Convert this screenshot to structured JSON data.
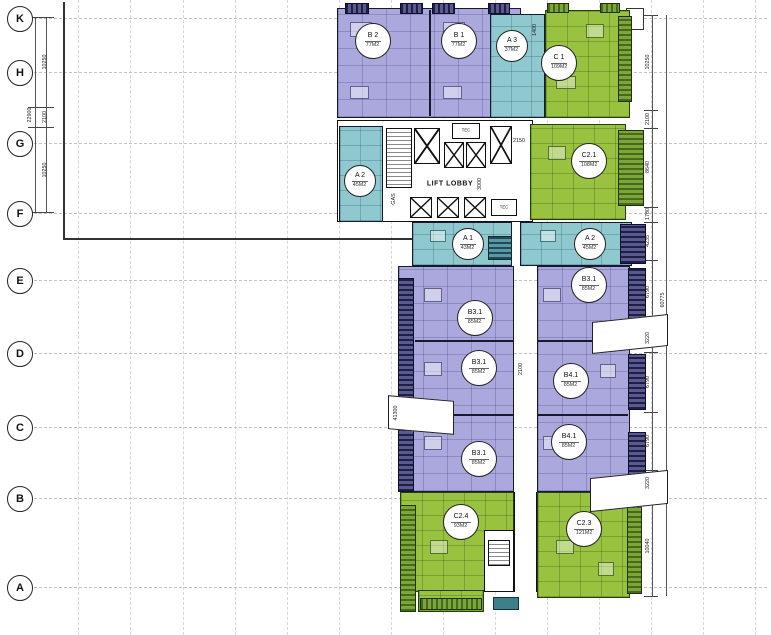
{
  "grid_rows": [
    {
      "label": "K"
    },
    {
      "label": "H"
    },
    {
      "label": "G"
    },
    {
      "label": "F"
    },
    {
      "label": "E"
    },
    {
      "label": "D"
    },
    {
      "label": "C"
    },
    {
      "label": "B"
    },
    {
      "label": "A"
    }
  ],
  "dims": {
    "left_overall": "22900",
    "left": [
      "10250",
      "2100",
      "10250"
    ],
    "right": [
      "10250",
      "2100",
      "8640",
      "1780",
      "4235",
      "6790",
      "3220",
      "6790",
      "6790",
      "3220",
      "10040"
    ],
    "right_overall": "60775",
    "inner": {
      "d1400": "1400",
      "d2150": "2150",
      "d3000": "3000",
      "d2100": "2100",
      "d41300": "41300"
    }
  },
  "labels": {
    "lift_lobby": "LIFT LOBBY",
    "tec": "TEC",
    "gas": "GAS"
  },
  "units": [
    {
      "code": "B 2",
      "area": "77M2"
    },
    {
      "code": "B 1",
      "area": "77M2"
    },
    {
      "code": "A 3",
      "area": "37M2"
    },
    {
      "code": "C 1",
      "area": "109M2"
    },
    {
      "code": "A 2",
      "area": "45M2"
    },
    {
      "code": "C2.1",
      "area": "108M2"
    },
    {
      "code": "A 1",
      "area": "43M2"
    },
    {
      "code": "A 2",
      "area": "45M2"
    },
    {
      "code": "B3.1",
      "area": "85M2"
    },
    {
      "code": "B3.1",
      "area": "85M2"
    },
    {
      "code": "B3.1",
      "area": "85M2"
    },
    {
      "code": "B4.1",
      "area": "85M2"
    },
    {
      "code": "B4.1",
      "area": "85M2"
    },
    {
      "code": "B3.1",
      "area": "85M2"
    },
    {
      "code": "C2.4",
      "area": "93M2"
    },
    {
      "code": "C2.3",
      "area": "121M2"
    }
  ],
  "colors": {
    "purple": "#aaa8dd",
    "teal": "#8fc8cf",
    "green": "#99c240",
    "navy": "#23234d",
    "green_dark": "#46691a",
    "teal_dark": "#1f4b57"
  }
}
